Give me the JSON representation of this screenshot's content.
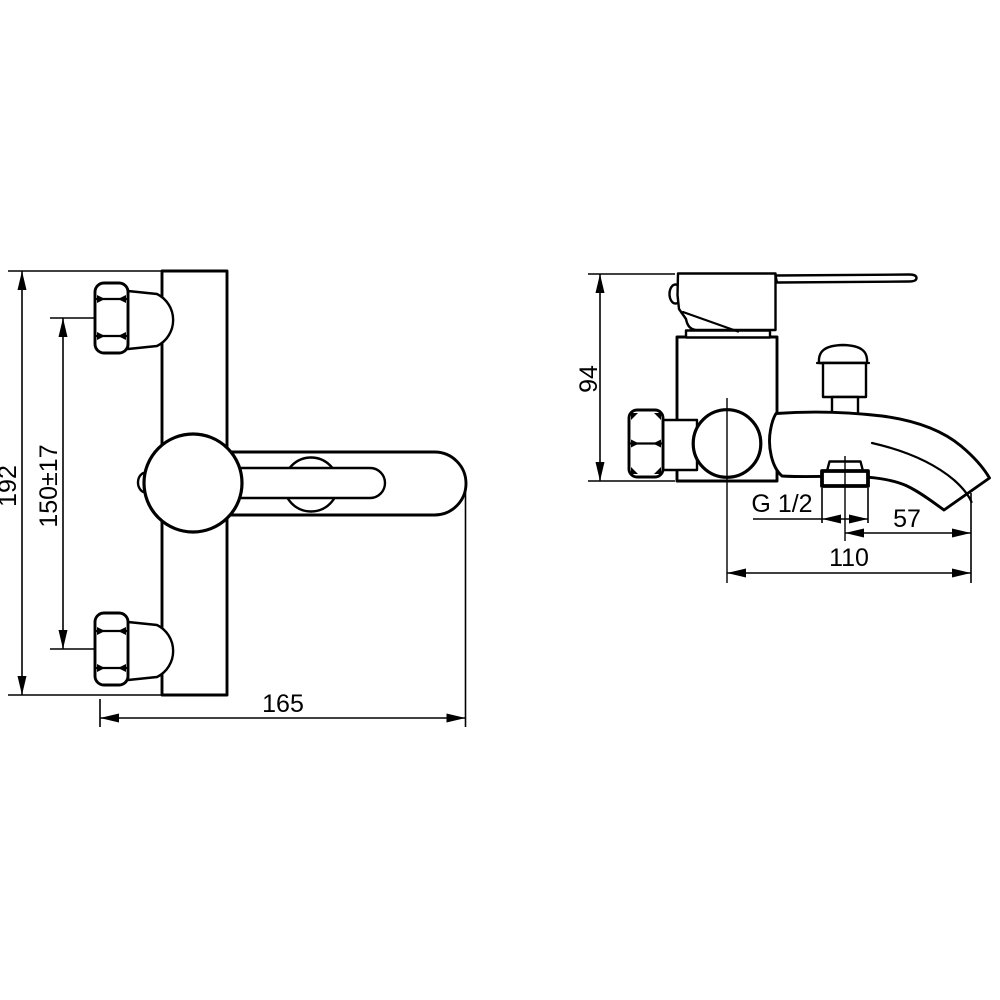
{
  "colors": {
    "line": "#000000",
    "background": "#ffffff"
  },
  "front_view": {
    "dimensions": [
      {
        "id": "total-height",
        "label": "192"
      },
      {
        "id": "hole-spacing",
        "label": "150±17"
      },
      {
        "id": "total-width",
        "label": "165"
      }
    ]
  },
  "side_view": {
    "dimensions": [
      {
        "id": "body-height",
        "label": "94"
      },
      {
        "id": "outlet-thread",
        "label": "G 1/2"
      },
      {
        "id": "outlet-to-spout-tip",
        "label": "57"
      },
      {
        "id": "spout-reach",
        "label": "110"
      }
    ]
  }
}
